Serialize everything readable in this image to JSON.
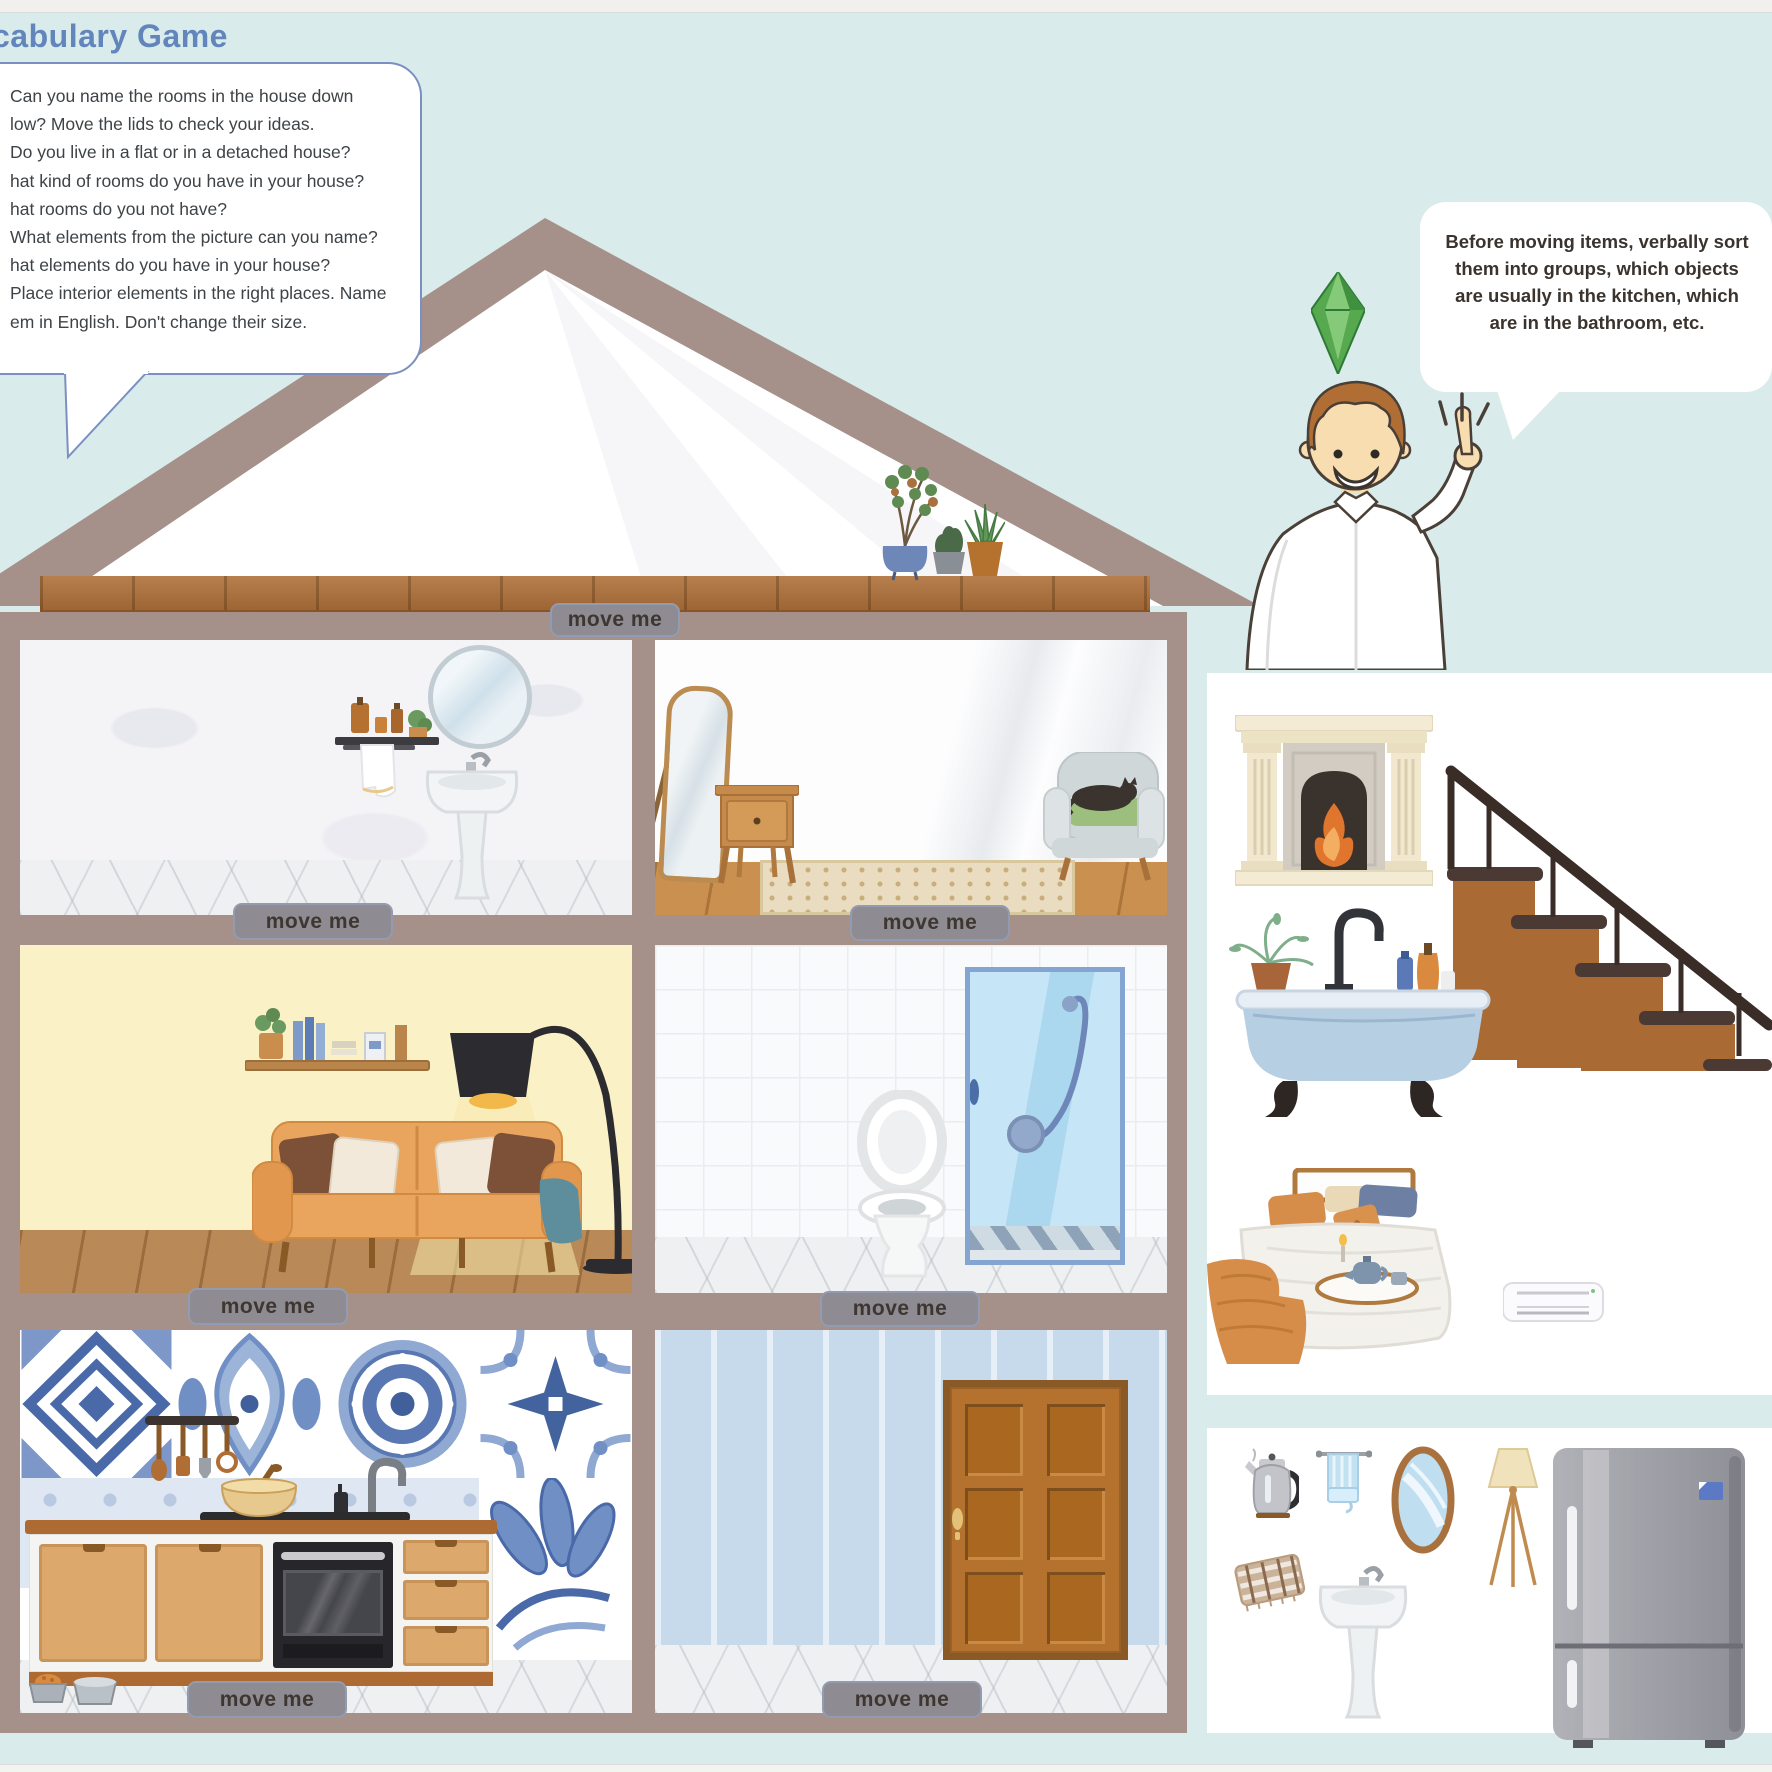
{
  "header": {
    "title": "cabulary Game"
  },
  "instruction_bubble": {
    "lines": [
      "Can you name the rooms in the house down",
      "low? Move the lids to check your ideas.",
      "Do you live in a flat or in a detached house?",
      "hat kind of rooms do you have in your house?",
      "hat rooms do you not have?",
      "What elements from the picture can you name?",
      "hat elements do you have in your house?",
      "Place interior elements in the right places. Name",
      "em in English. Don't change their size."
    ]
  },
  "helper_bubble": {
    "lines": [
      "Before moving items, verbally sort",
      "them into groups, which objects",
      "are usually in the kitchen, which",
      "are in the bathroom, etc."
    ]
  },
  "labels": {
    "move_me": "move me"
  },
  "house": {
    "rooms": [
      "attic",
      "bathroom-upstairs",
      "bedroom",
      "living-room",
      "shower-room",
      "kitchen",
      "hallway"
    ]
  },
  "item_trays": {
    "large_items": [
      "fireplace",
      "staircase",
      "bathtub",
      "bed",
      "air-conditioner"
    ],
    "small_items": [
      "kettle",
      "towel",
      "oval-mirror",
      "floor-lamp",
      "fridge",
      "blanket",
      "washbasin"
    ]
  },
  "colors": {
    "background": "#d9eceb",
    "house_frame": "#a5908a",
    "title": "#6286bb",
    "bubble_border": "#7b90c2",
    "label_bg": "#8e8c92",
    "label_text": "#3e3630",
    "living_wall": "#fbf1c6",
    "hallway_wall": "#c7daec",
    "tile_blue": "#5d7fba",
    "sofa_orange": "#e9a55e",
    "plumbob_green": "#57a94f"
  }
}
